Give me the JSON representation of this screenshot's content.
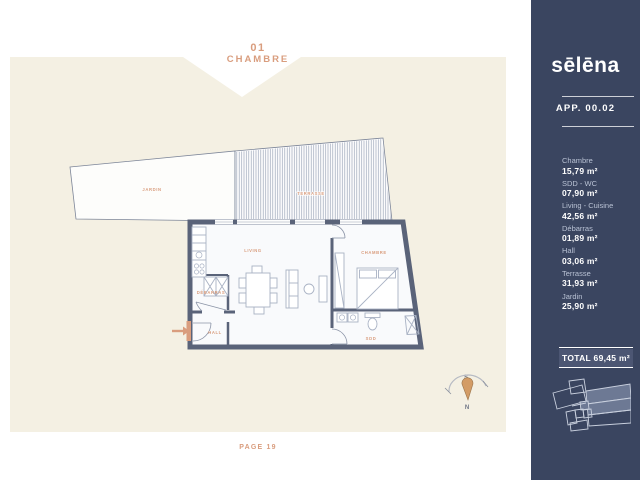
{
  "colors": {
    "accent": "#d99d7e",
    "navy": "#3a4560",
    "cream": "#f4f0e3",
    "wall": "#5a6379",
    "furniture_line": "#a9b2c4",
    "total_box_bg": "#4c5673",
    "keyplan_highlight": "#6d7994"
  },
  "header": {
    "number": "01",
    "title": "CHAMBRE"
  },
  "footer": {
    "label": "PAGE 19"
  },
  "sidebar": {
    "logo": "sēlēna",
    "apartment_label": "APP. 00.02",
    "rooms": [
      {
        "name": "Chambre",
        "area": "15,79 m²"
      },
      {
        "name": "SDD - WC",
        "area": "07,90 m²"
      },
      {
        "name": "Living - Cuisine",
        "area": "42,56 m²"
      },
      {
        "name": "Débarras",
        "area": "01,89 m²"
      },
      {
        "name": "Hall",
        "area": "03,06 m²"
      },
      {
        "name": "Terrasse",
        "area": "31,93 m²"
      },
      {
        "name": "Jardin",
        "area": "25,90 m²"
      }
    ],
    "total_label": "TOTAL 69,45 m²"
  },
  "plan": {
    "room_labels": {
      "jardin": "JARDIN",
      "terrasse": "TERRASSE",
      "living": "LIVING",
      "chambre": "CHAMBRE",
      "debarras": "DÉBARRAS",
      "hall": "HALL",
      "sdd": "SDD"
    },
    "compass": {
      "south": "S",
      "north": "N"
    }
  }
}
